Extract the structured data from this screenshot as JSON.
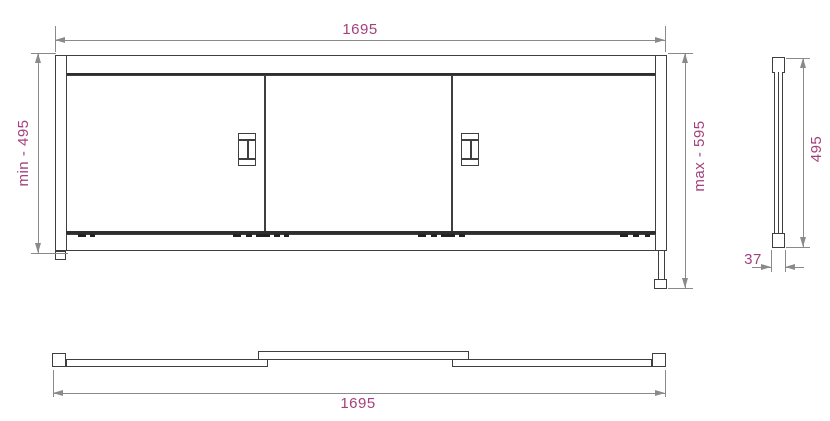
{
  "colors": {
    "dim-text": "#a3417d",
    "draw-line": "#3f3f3f",
    "thick-line": "#2e2e2e",
    "dim-line": "#8a8a8a"
  },
  "dimensions": {
    "front_width": "1695",
    "front_min_height": "min - 495",
    "front_max_height": "max - 595",
    "side_height": "495",
    "side_depth": "37",
    "plan_width": "1695"
  }
}
